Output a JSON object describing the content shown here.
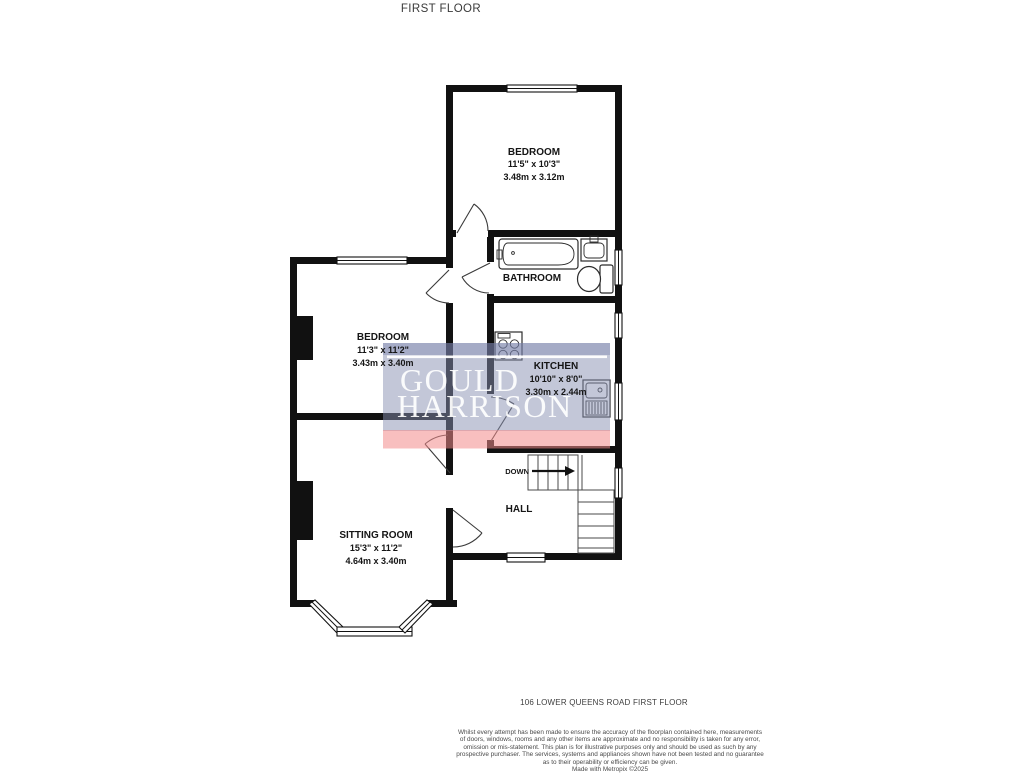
{
  "title": "FIRST FLOOR",
  "plan": {
    "rooms": {
      "bedroom_top": {
        "name": "BEDROOM",
        "imperial": "11'5\" x 10'3\"",
        "metric": "3.48m x 3.12m"
      },
      "bathroom": {
        "name": "BATHROOM"
      },
      "bedroom_middle": {
        "name": "BEDROOM",
        "imperial": "11'3\" x 11'2\"",
        "metric": "3.43m x 3.40m"
      },
      "kitchen": {
        "name": "KITCHEN",
        "imperial": "10'10\" x 8'0\"",
        "metric": "3.30m x 2.44m"
      },
      "sitting_room": {
        "name": "SITTING ROOM",
        "imperial": "15'3\" x 11'2\"",
        "metric": "4.64m x 3.40m"
      },
      "hall": {
        "name": "HALL"
      },
      "stairs": {
        "direction_label": "DOWN"
      }
    }
  },
  "watermark": {
    "line1": "GOULD",
    "line2": "HARRISON"
  },
  "footer": {
    "address": "106 LOWER QUEENS ROAD FIRST FLOOR",
    "disclaimer_lines": [
      "Whilst every attempt has been made to ensure the accuracy of the floorplan contained here, measurements",
      "of doors, windows, rooms and any other items are approximate and no responsibility is taken for any error,",
      "omission or mis-statement. This plan is for illustrative purposes only and should be used as such by any",
      "prospective purchaser. The services, systems and appliances shown have not been tested and no guarantee",
      "as to their operability or efficiency can be given."
    ],
    "credit": "Made with Metropix ©2025"
  },
  "colors": {
    "wall": "#111111",
    "watermark_blue": "#8890b2",
    "watermark_red": "#f28b8b",
    "text": "#1a1a1a"
  }
}
